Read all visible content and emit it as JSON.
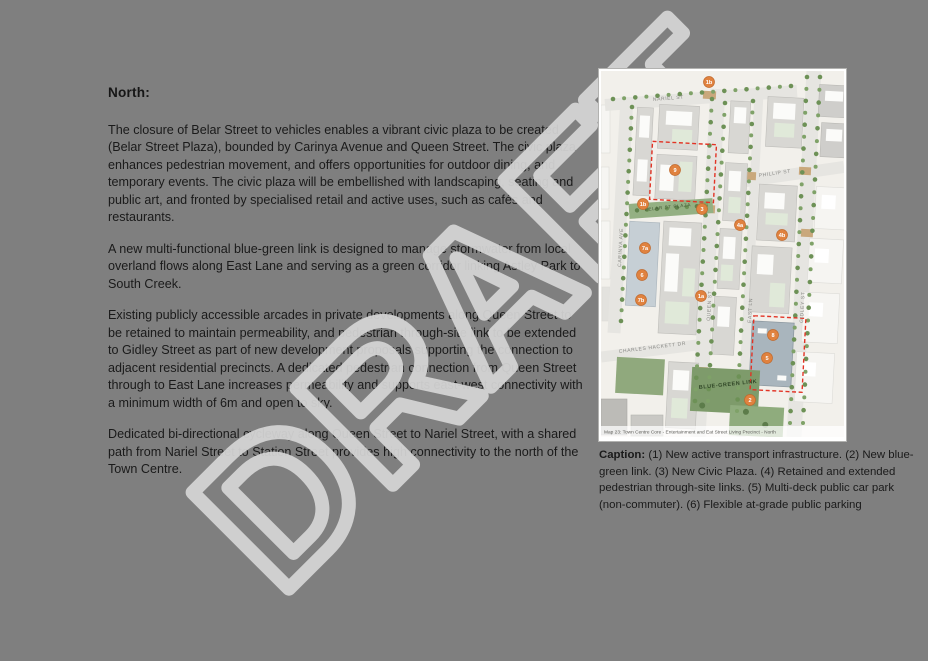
{
  "page": {
    "background_color": "#7f7f7f",
    "watermark_text": "DRAFT"
  },
  "article": {
    "heading": "North:",
    "paragraphs": [
      "The closure of Belar Street to vehicles enables a vibrant civic plaza to be created (Belar Street Plaza), bounded by Carinya Avenue and Queen Street. The civic plaza enhances pedestrian movement, and offers opportunities for outdoor dining, and temporary events. The civic plaza will be embellished with landscaping, seating and public art, and fronted by specialised retail and active uses, such as cafés and restaurants.",
      "A new multi-functional blue-green link is designed to manage stormwater from local overland flows along East Lane and serving as a green corridor linking Astley Park to South Creek.",
      "Existing publicly accessible arcades in private developments along Queen Street to be retained to maintain permeability, and pedestrian through-site link to be extended to Gidley Street as part of new development proposals supporting the connection to adjacent residential precincts. A dedicated pedestrian connection from Queen Street through to East Lane increases permeability and supports east-west connectivity with a minimum width of 6m and open to sky.",
      "Dedicated bi-directional cycleway along Queen Street to Nariel Street, with a shared path from Nariel Street to Station Street provides high connectivity to the north of the Town Centre."
    ]
  },
  "map_figure": {
    "figure_caption": "Map 23: Town Centre Core - Entertainment and Eat Street Living Precinct - North",
    "street_labels": {
      "nariel": "NARIEL ST",
      "phillip": "PHILLIP ST",
      "carinya": "CARINYA AVE",
      "queen": "QUEEN ST",
      "east_lane": "EAST LN",
      "gidley": "GIDLEY ST",
      "charles_hackett": "CHARLES HACKETT DR"
    },
    "area_labels": {
      "belar_plaza": "BELAR ST PLAZA",
      "blue_green_link": "BLUE-GREEN LINK"
    },
    "markers": [
      "1b",
      "9",
      "1b",
      "3",
      "4a",
      "4b",
      "7a",
      "6",
      "7b",
      "1a",
      "8",
      "5",
      "2"
    ],
    "colors": {
      "marker_orange": "#e0823f",
      "dashed_red": "#e23325",
      "link_green": "#7e9b6b",
      "car_park_bluegray": "#a9b5bd",
      "parking_bluegray": "#c6cfd5"
    }
  },
  "caption_block": {
    "label": "Caption:",
    "text": "(1) New active transport infrastructure. (2) New blue-green link. (3) New Civic Plaza. (4) Retained and extended pedestrian through-site links. (5) Multi-deck public car park (non-commuter). (6) Flexible at-grade public parking"
  }
}
